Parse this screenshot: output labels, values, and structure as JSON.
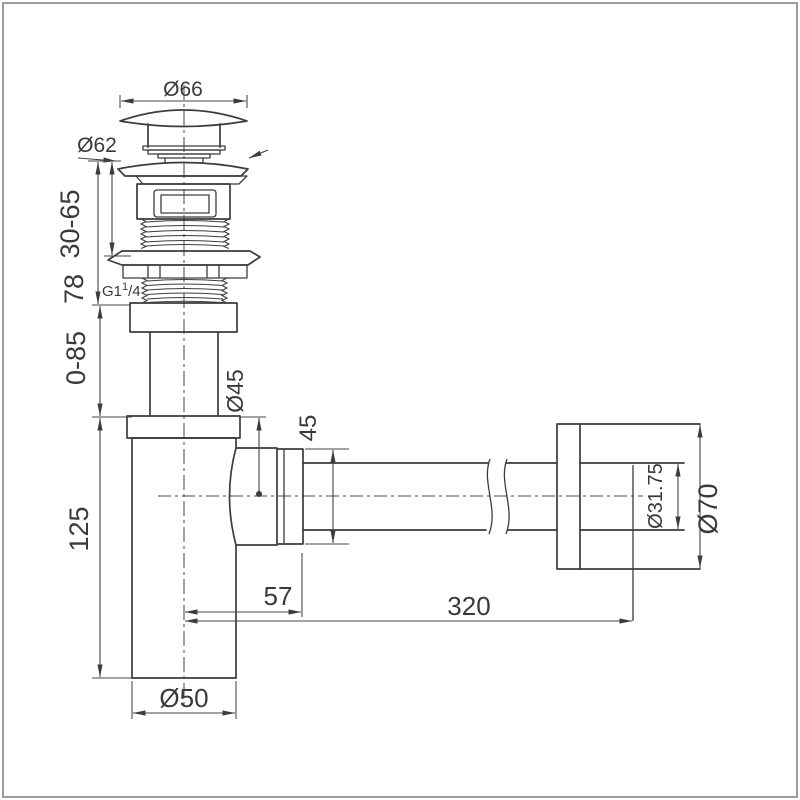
{
  "drawing": {
    "type": "technical-dimension-drawing",
    "subject": "Basin pop-up waste with bottle trap and wall outlet pipe",
    "background_color": "#ffffff",
    "line_color": "#3c3c3c",
    "dimensions": {
      "cap_diameter": "Ø66",
      "flange_diameter": "Ø62",
      "mounting_range": "30-65",
      "waste_height": "78",
      "thread_size_base": "G1",
      "thread_size_sup": "1",
      "thread_size_rest": "/4",
      "tailpiece_adjust_range": "0-85",
      "inlet_diameter": "Ø45",
      "outlet_nut_height": "45",
      "trap_body_height": "125",
      "centre_to_pipe_start": "57",
      "pipe_length": "320",
      "pipe_end_diameter": "Ø31.75",
      "wall_flange_diameter": "Ø70",
      "trap_body_diameter": "Ø50"
    }
  }
}
